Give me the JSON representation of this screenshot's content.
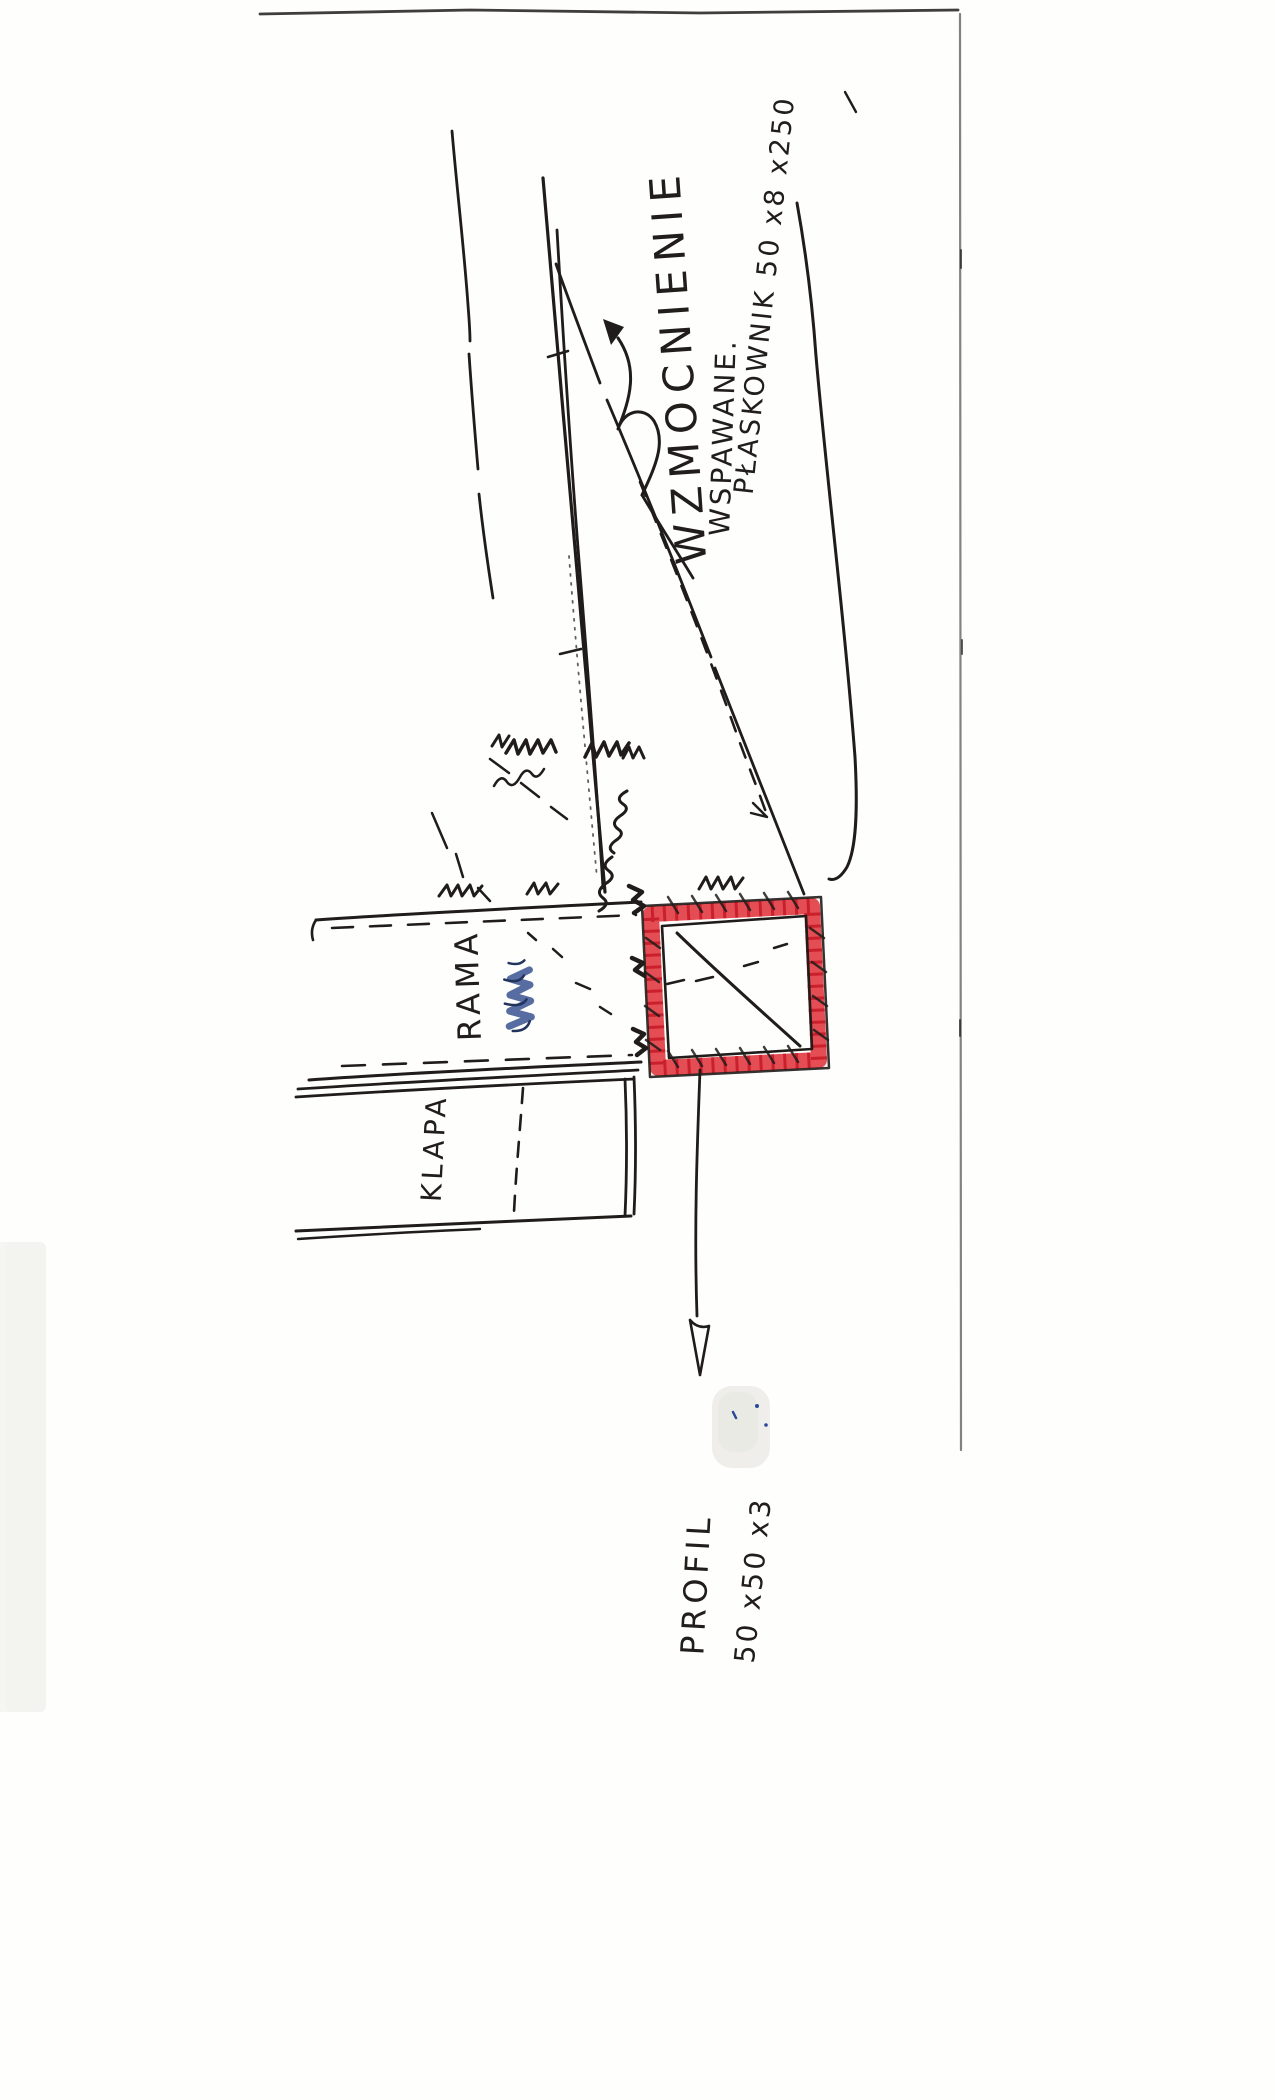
{
  "sketch": {
    "annotations": {
      "reinforcement_label": "WZMOCNIENIE",
      "welded_label": "WSPAWANE.",
      "flat_bar_label": "PŁASKOWNIK  50 x8 x250",
      "frame_label": "RAMA",
      "flap_label": "KLAPA",
      "profile_label": "PROFIL",
      "profile_size_label": "50 x50 x3"
    },
    "colors": {
      "ink": "#1f1c1a",
      "highlighter_red": "#e23a42",
      "hatch_red": "#c21520",
      "pen_blue": "#3a5390"
    }
  }
}
